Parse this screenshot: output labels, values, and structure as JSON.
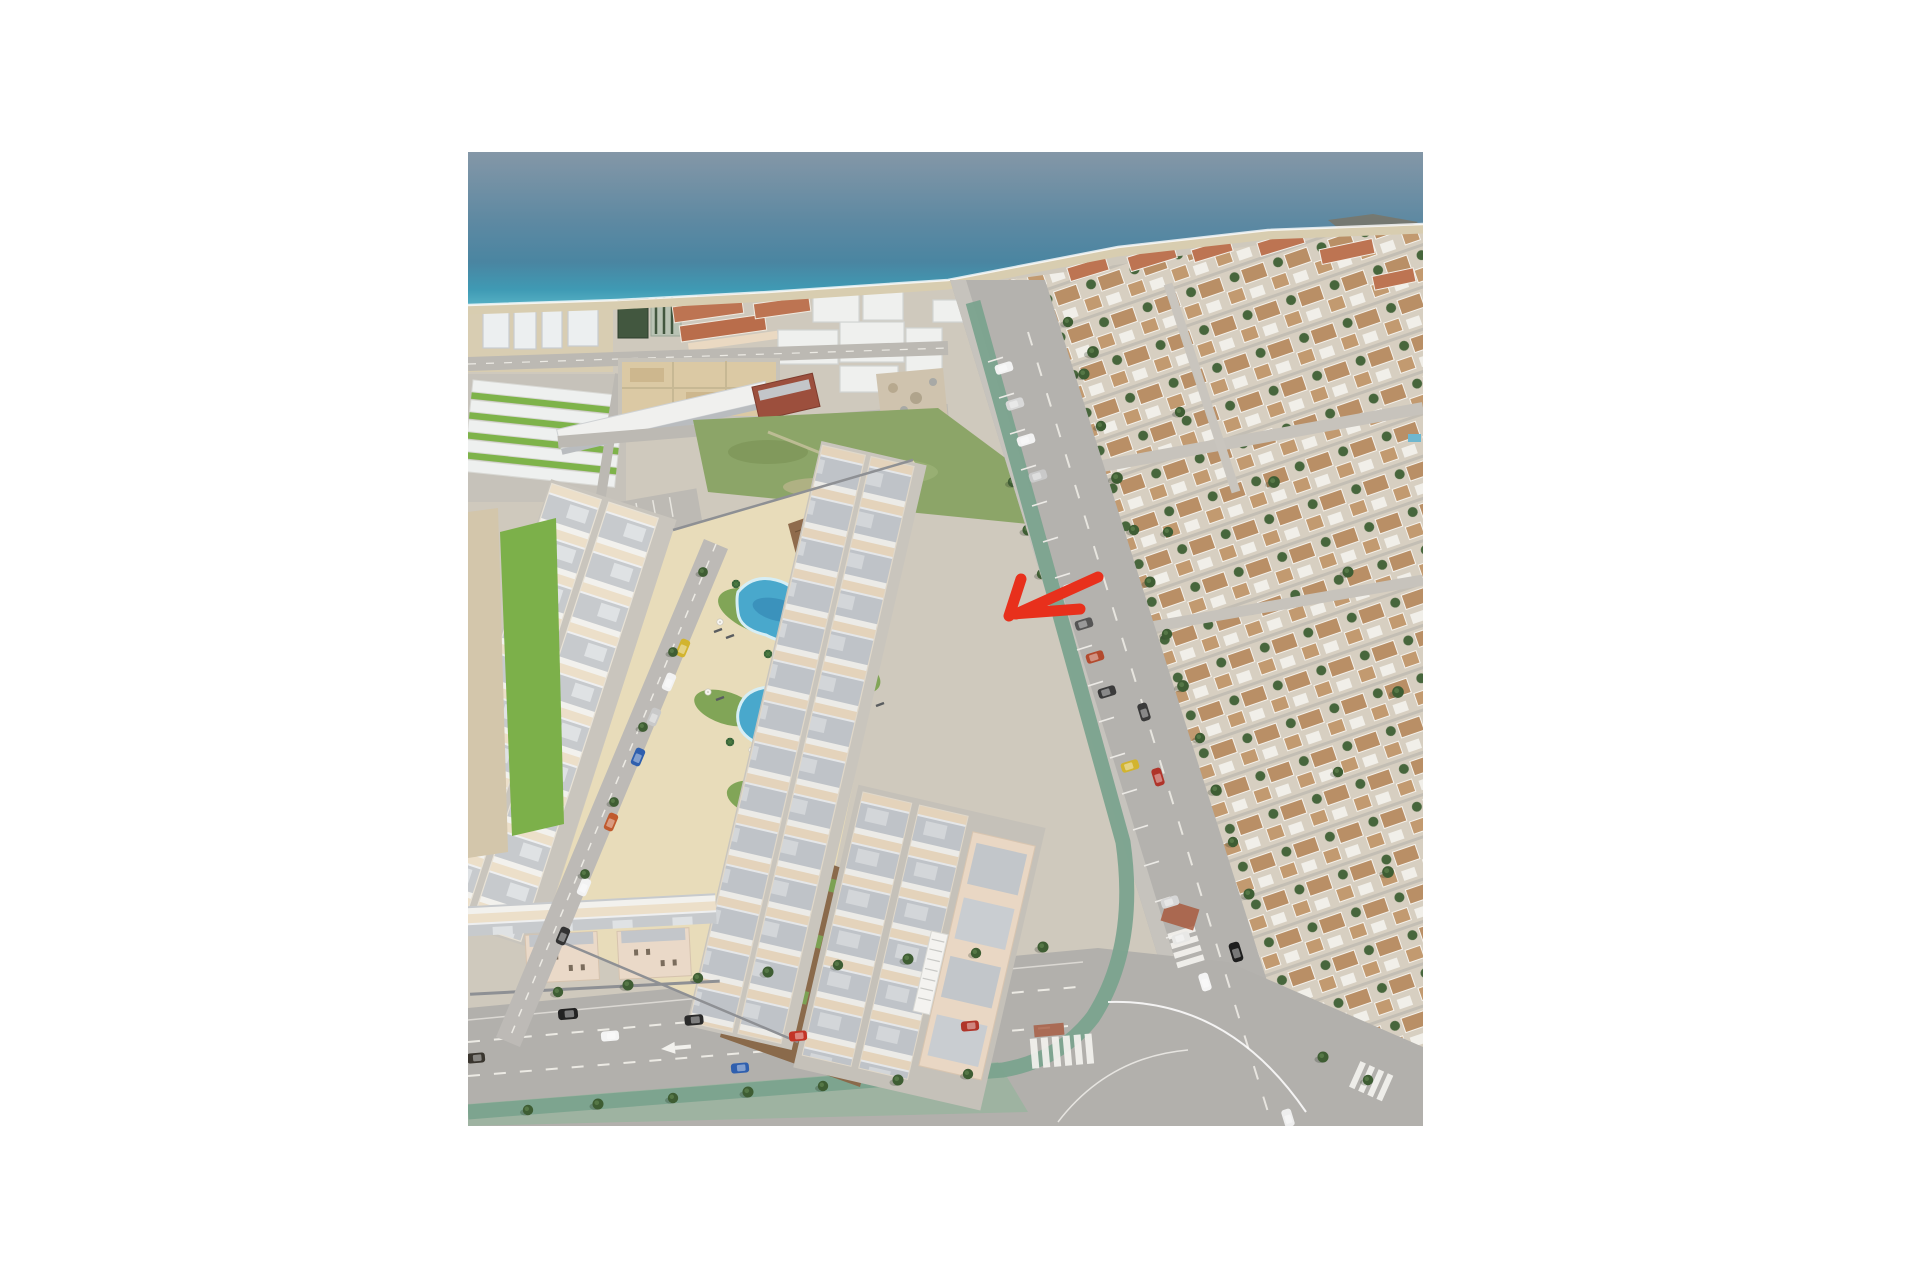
{
  "photo": {
    "type": "aerial-3d-render",
    "subject": "new-build seaside residential development with communal pool gardens, flanked by an avenue, a coastal village and the sea",
    "annotation": {
      "type": "hand-drawn-arrow",
      "color": "#e8301c",
      "points_to": "townhouse-row-beside-avenue"
    },
    "colors": {
      "sea_deep": "#5e89a2",
      "sea_shallow": "#55b0c4",
      "beach": "#d8cdb0",
      "pool": "#49a8cc",
      "pool_deep": "#2f7fae",
      "deck_sand": "#e8dcba",
      "lawn": "#81a557",
      "meadow": "#8ca568",
      "wood_deck": "#8a6a4b",
      "roof_grey": "#c7cacd",
      "wall_cream": "#ecdfc9",
      "village_roof": "#b98f66",
      "terracotta_roof": "#bd7452",
      "asphalt": "#b4b2ae",
      "bike_lane": "#7ba38e",
      "sidewalk_green": "#9eb3a1",
      "estate_lawn": "#7eb34a",
      "playground": "#a85038",
      "tree": "#3e5d33",
      "arrow": "#e8301c"
    },
    "regions": [
      "sea",
      "beach",
      "coastal-town",
      "seaside-village",
      "meadow",
      "development-left-row",
      "development-right-row",
      "pool-amenity-area",
      "phase-two-block",
      "avenue",
      "bottom-road",
      "junction",
      "red-arrow-annotation"
    ]
  }
}
